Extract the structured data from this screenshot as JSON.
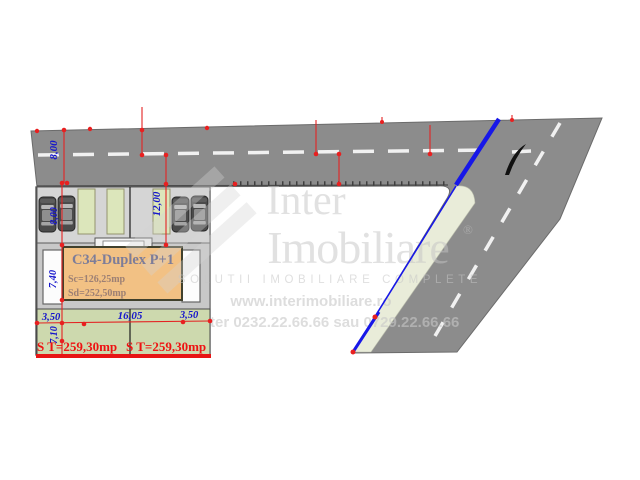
{
  "plan": {
    "building": {
      "title": "C34-Duplex P+1",
      "built_area": "Sc=126,25mp",
      "developed_area": "Sd=252,50mp"
    },
    "dims": {
      "road_width": "8,00",
      "parking_depth": "8,00",
      "side_depth": "12,00",
      "building_depth": "7,40",
      "yard_depth": "7,10",
      "front_left": "3,50",
      "front_width": "16,05",
      "front_right": "3,50"
    },
    "lots": {
      "left_area": "S T=259,30mp",
      "right_area": "S T=259,30mp"
    }
  },
  "watermark": {
    "brand_top": "Inter",
    "brand_bottom": "Imobiliare",
    "registered_mark": "®",
    "tagline": "SOLUTII IMOBILIARE COMPLETE",
    "website": "www.interimobiliare.ro",
    "phone": "ter 0232.22.66.66 sau 0729.22.66.66"
  },
  "colors": {
    "road": "#8c8c8c",
    "sidewalk": "#e9ecd9",
    "parking": "#d5d5d5",
    "green_strip": "#dce6bb",
    "yard": "#cdd9ae",
    "building": "#f2c184",
    "dimension_blue": "#1515cc",
    "annotation_red": "#e42222",
    "boundary_blue": "#1717e8"
  }
}
